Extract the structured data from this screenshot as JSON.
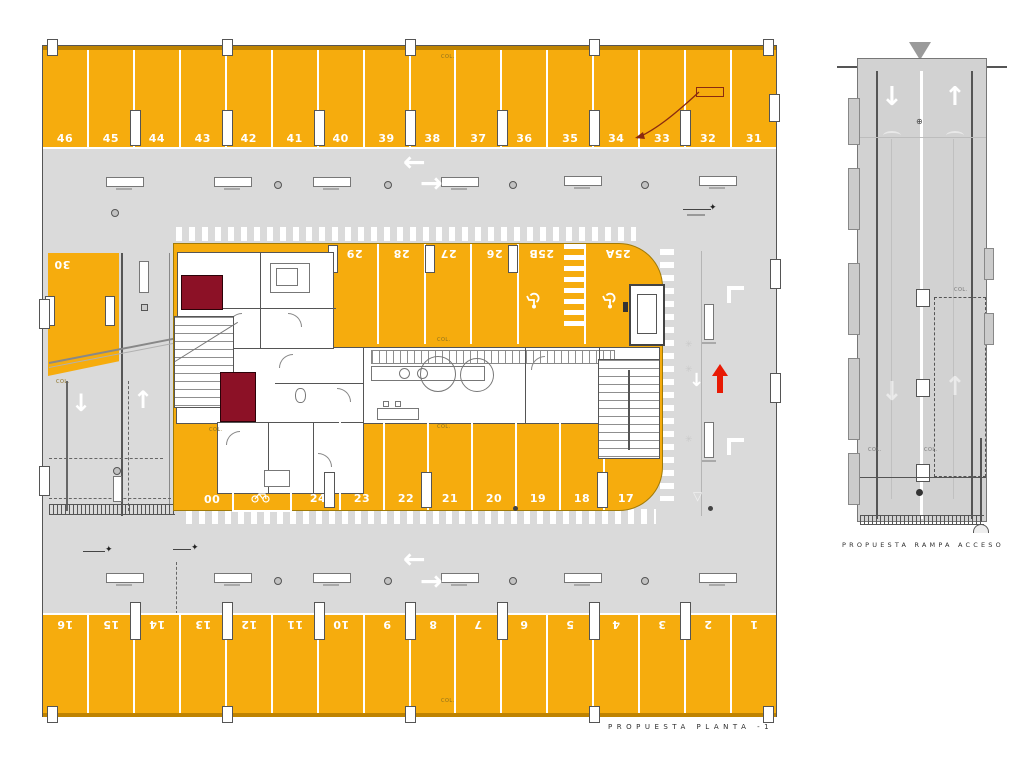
{
  "captions": {
    "plan": "PROPUESTA PLANTA -1",
    "ramp": "PROPUESTA RAMPA ACCESO"
  },
  "parking": {
    "top": [
      "46",
      "45",
      "44",
      "43",
      "42",
      "41",
      "40",
      "39",
      "38",
      "37",
      "36",
      "35",
      "34",
      "33",
      "32",
      "31"
    ],
    "bottom": [
      "16",
      "15",
      "14",
      "13",
      "12",
      "11",
      "10",
      "9",
      "8",
      "7",
      "6",
      "5",
      "4",
      "3",
      "2",
      "1"
    ],
    "island_upper": [
      "29",
      "28",
      "27",
      "26",
      "25B"
    ],
    "island_upper_end": "25A",
    "island_lower": [
      "24",
      "23",
      "22",
      "21",
      "20",
      "19",
      "18",
      "17"
    ],
    "island_lower_start": "00",
    "left_space": "30"
  },
  "labels": {
    "column": "COL."
  },
  "glyphs": {
    "arrow_left": "←",
    "arrow_right": "→",
    "arrow_up": "↑",
    "arrow_down": "↓",
    "marker_star": "✦",
    "sun": "✳",
    "circled_plus": "⊕",
    "triangle_down": "▽"
  },
  "colors": {
    "parking_orange": "#F6AC0D",
    "floor_gray": "#DADADA",
    "maroon_room": "#8C1126",
    "red_arrow": "#E81A04"
  }
}
